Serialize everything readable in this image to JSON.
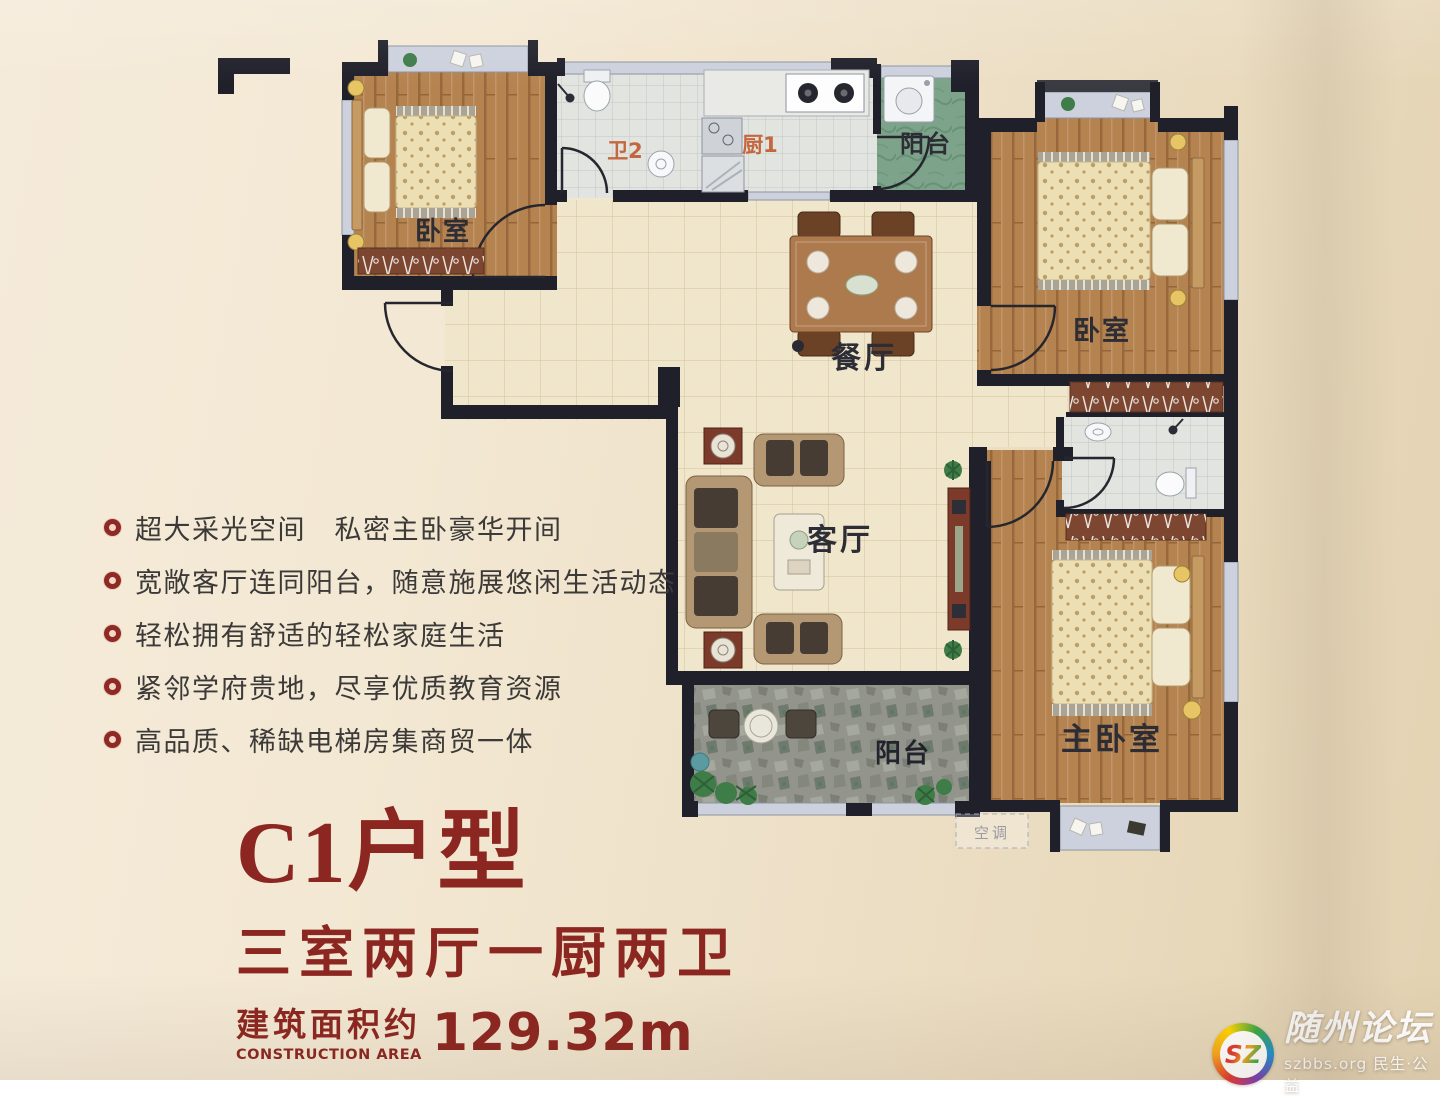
{
  "flyer": {
    "features": [
      "超大采光空间　私密主卧豪华开间",
      "宽敞客厅连同阳台，随意施展悠闲生活动态",
      "轻松拥有舒适的轻松家庭生活",
      "紧邻学府贵地，尽享优质教育资源",
      "高品质、稀缺电梯房集商贸一体"
    ],
    "title": {
      "model": "C1户型",
      "layout": "三室两厅一厨两卫",
      "area_label_cn": "建筑面积约",
      "area_label_en": "CONSTRUCTION AREA",
      "area_value": "129.32m"
    }
  },
  "plan": {
    "rooms": {
      "bedroom_tl": "卧室",
      "bath2": "卫2",
      "kitchen": "厨1",
      "balcony_top": "阳台",
      "bedroom_right": "卧室",
      "dining": "餐厅",
      "living": "客厅",
      "master_bedroom": "主卧室",
      "balcony_bottom": "阳台",
      "ac_platform": "空调"
    }
  },
  "watermark": {
    "logo_text": "SZ",
    "site_name": "随州论坛",
    "site_info": "szbbs.org 民生·公益"
  },
  "colors": {
    "accent_red": "#8e2a23",
    "wall_dark": "#20202b",
    "label_dark": "#2d2d36",
    "label_orange": "#c4673f",
    "wood": "#b5834f",
    "tile_beige": "#f0e6cb",
    "balcony_green": "#7da38a",
    "stone_gray": "#93948c",
    "paper": "#efe3cd"
  }
}
